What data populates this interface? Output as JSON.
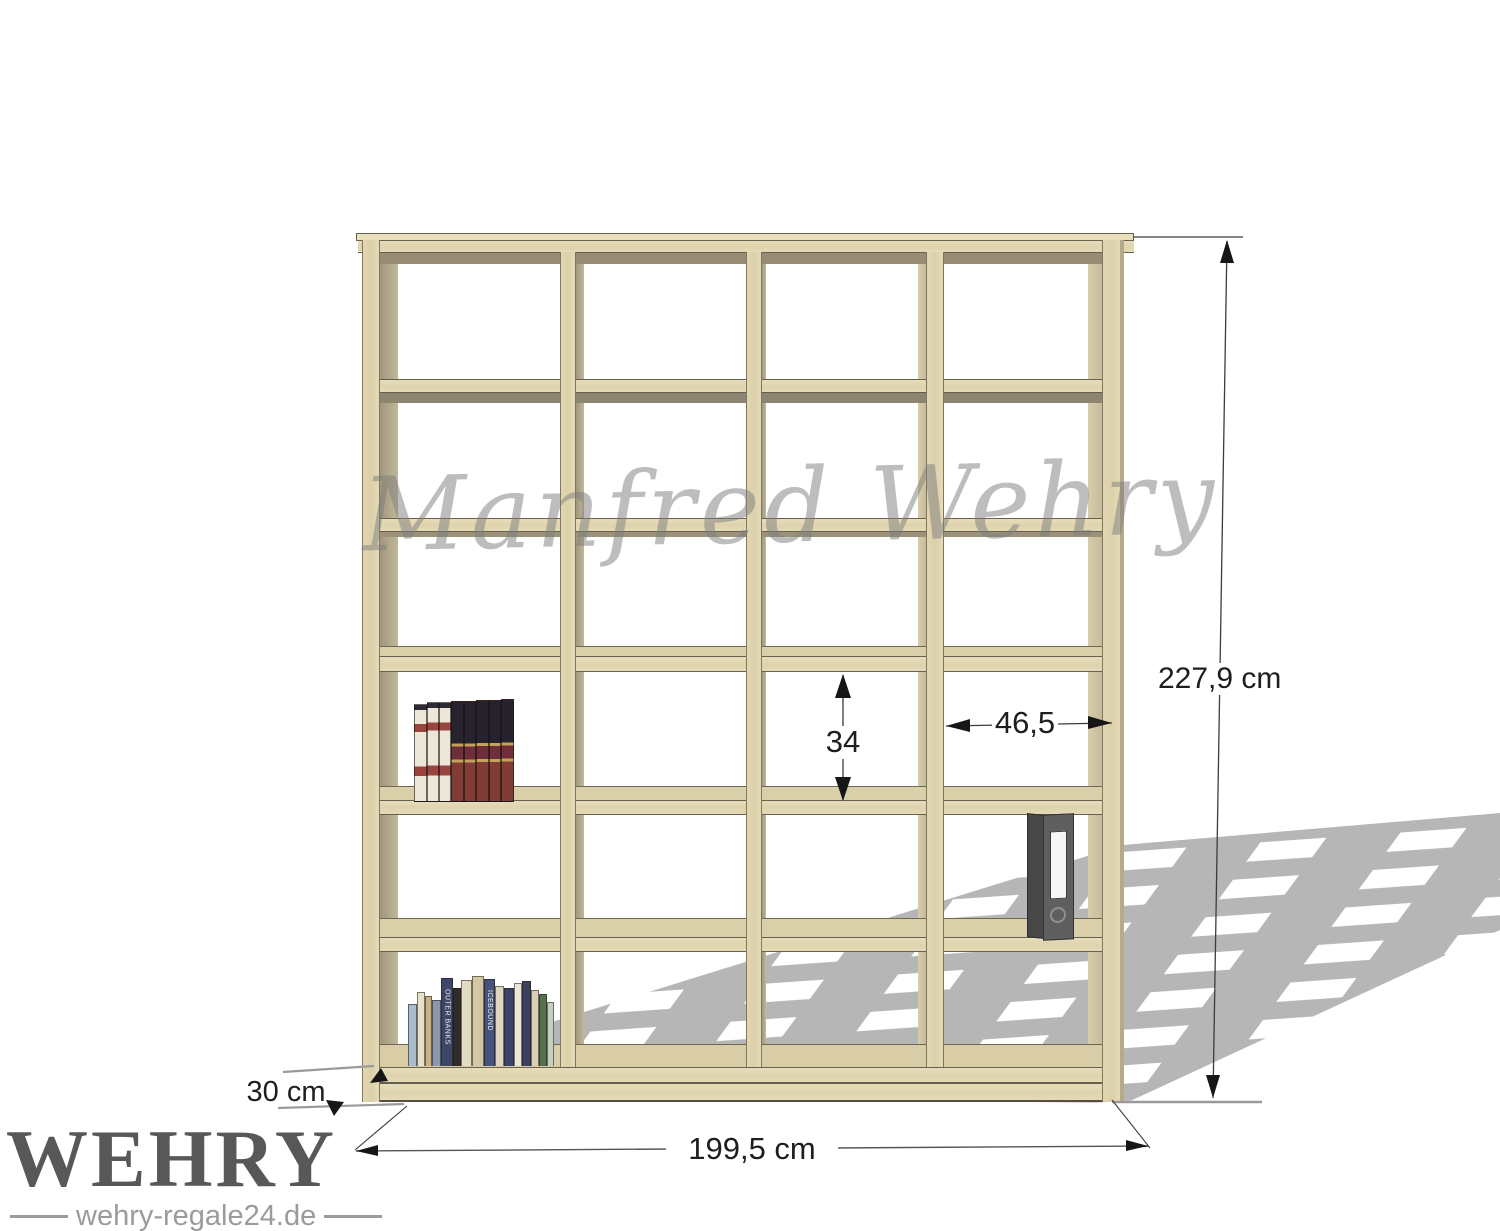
{
  "dimensions": {
    "height": "227,9 cm",
    "width": "199,5 cm",
    "depth": "30 cm",
    "inner_cell_height": "34",
    "inner_cell_width": "46,5"
  },
  "watermark": {
    "text": "Manfred Wehry"
  },
  "logo": {
    "brand": "WEHRY",
    "website": "wehry-regale24.de"
  },
  "shelf": {
    "type": "open cube shelving unit",
    "columns": 4,
    "rows": 6,
    "wood_color": "#e0d5af",
    "inner_face_color": "#b2a88c",
    "shadow_color": "#b6b6b6"
  },
  "contents": {
    "encyclopedia_volumes": 8,
    "paperback_titles": [
      "OUTER BANKS",
      "ICEBOUND"
    ],
    "binder_color": "#565656"
  }
}
